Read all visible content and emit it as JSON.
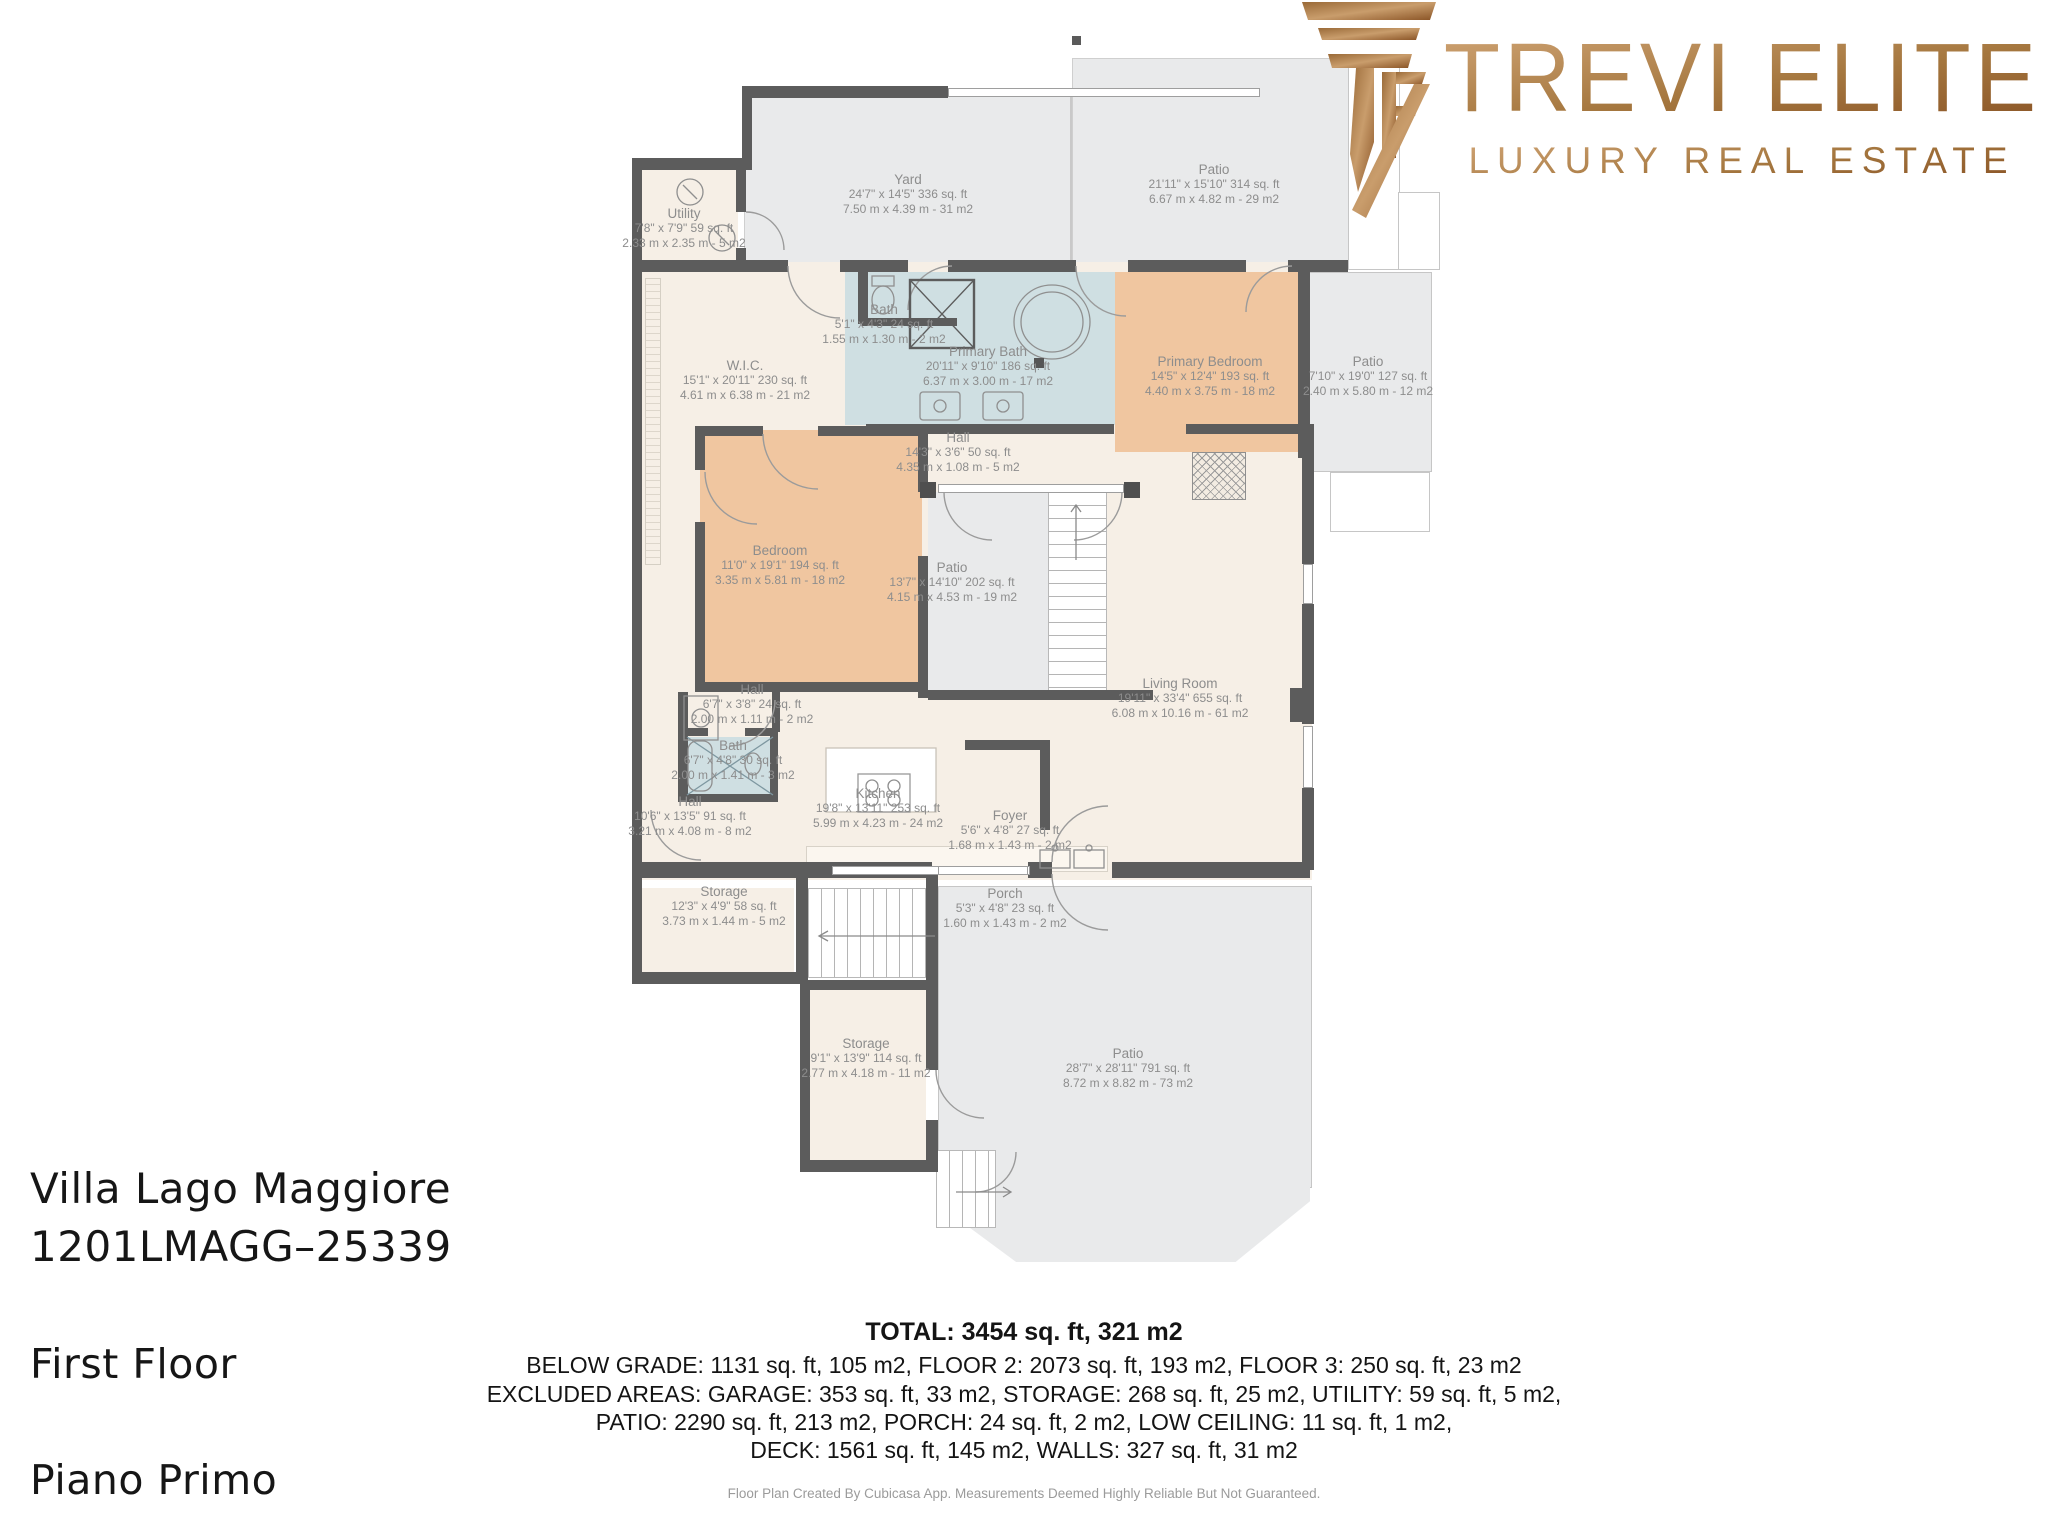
{
  "brand": {
    "monogram": "TE",
    "name": "TREVI ELITE",
    "tagline": "LUXURY REAL ESTATE",
    "gold_dark": "#8a5426",
    "gold_light": "#c99d6c"
  },
  "property": {
    "name": "Villa Lago Maggiore",
    "listing_code": "1201LMAGG–25339",
    "floor_label_en": "First Floor",
    "floor_label_it": "Piano Primo"
  },
  "summary": {
    "total": "TOTAL: 3454 sq. ft, 321 m2",
    "line1": "BELOW GRADE: 1131 sq. ft, 105 m2, FLOOR 2: 2073 sq. ft, 193 m2, FLOOR 3: 250 sq. ft, 23 m2",
    "line2": "EXCLUDED AREAS: GARAGE: 353 sq. ft, 33 m2, STORAGE: 268 sq. ft, 25 m2, UTILITY: 59 sq. ft, 5 m2,",
    "line3": "PATIO: 2290 sq. ft, 213 m2, PORCH: 24 sq. ft, 2 m2, LOW CEILING: 11 sq. ft, 1 m2,",
    "line4": "DECK: 1561 sq. ft, 145 m2, WALLS: 327 sq. ft, 31 m2",
    "disclaimer": "Floor Plan Created By Cubicasa App. Measurements Deemed Highly Reliable But Not Guaranteed."
  },
  "rooms": [
    {
      "name": "Utility",
      "dim_ft": "7'8\" x 7'9\" 59 sq. ft",
      "dim_m": "2.33 m x 2.35 m - 5 m2"
    },
    {
      "name": "Yard",
      "dim_ft": "24'7\" x 14'5\" 336 sq. ft",
      "dim_m": "7.50 m x 4.39 m - 31 m2"
    },
    {
      "name": "Patio",
      "dim_ft": "21'11\" x 15'10\" 314 sq. ft",
      "dim_m": "6.67 m x 4.82 m - 29 m2"
    },
    {
      "name": "W.I.C.",
      "dim_ft": "15'1\" x 20'11\" 230 sq. ft",
      "dim_m": "4.61 m x 6.38 m - 21 m2"
    },
    {
      "name": "Bath",
      "dim_ft": "5'1\" x 4'3\" 24 sq. ft",
      "dim_m": "1.55 m x 1.30 m - 2 m2"
    },
    {
      "name": "Primary Bath",
      "dim_ft": "20'11\" x 9'10\" 186 sq. ft",
      "dim_m": "6.37 m x 3.00 m - 17 m2"
    },
    {
      "name": "Primary Bedroom",
      "dim_ft": "14'5\" x 12'4\" 193 sq. ft",
      "dim_m": "4.40 m x 3.75 m - 18 m2"
    },
    {
      "name": "Patio",
      "dim_ft": "7'10\" x 19'0\" 127 sq. ft",
      "dim_m": "2.40 m x 5.80 m - 12 m2"
    },
    {
      "name": "Hall",
      "dim_ft": "14'3\" x 3'6\" 50 sq. ft",
      "dim_m": "4.35 m x 1.08 m - 5 m2"
    },
    {
      "name": "Bedroom",
      "dim_ft": "11'0\" x 19'1\" 194 sq. ft",
      "dim_m": "3.35 m x 5.81 m - 18 m2"
    },
    {
      "name": "Patio",
      "dim_ft": "13'7\" x 14'10\" 202 sq. ft",
      "dim_m": "4.15 m x 4.53 m - 19 m2"
    },
    {
      "name": "Living Room",
      "dim_ft": "19'11\" x 33'4\" 655 sq. ft",
      "dim_m": "6.08 m x 10.16 m - 61 m2"
    },
    {
      "name": "Hall",
      "dim_ft": "6'7\" x 3'8\" 24 sq. ft",
      "dim_m": "2.00 m x 1.11 m - 2 m2"
    },
    {
      "name": "Bath",
      "dim_ft": "6'7\" x 4'8\" 30 sq. ft",
      "dim_m": "2.00 m x 1.41 m - 3 m2"
    },
    {
      "name": "Hall",
      "dim_ft": "10'6\" x 13'5\" 91 sq. ft",
      "dim_m": "3.21 m x 4.08 m - 8 m2"
    },
    {
      "name": "Kitchen",
      "dim_ft": "19'8\" x 13'11\" 253 sq. ft",
      "dim_m": "5.99 m x 4.23 m - 24 m2"
    },
    {
      "name": "Foyer",
      "dim_ft": "5'6\" x 4'8\" 27 sq. ft",
      "dim_m": "1.68 m x 1.43 m - 2 m2"
    },
    {
      "name": "Storage",
      "dim_ft": "12'3\" x 4'9\" 58 sq. ft",
      "dim_m": "3.73 m x 1.44 m - 5 m2"
    },
    {
      "name": "Porch",
      "dim_ft": "5'3\" x 4'8\" 23 sq. ft",
      "dim_m": "1.60 m x 1.43 m - 2 m2"
    },
    {
      "name": "Storage",
      "dim_ft": "9'1\" x 13'9\" 114 sq. ft",
      "dim_m": "2.77 m x 4.18 m - 11 m2"
    },
    {
      "name": "Patio",
      "dim_ft": "28'7\" x 28'11\" 791 sq. ft",
      "dim_m": "8.72 m x 8.82 m - 73 m2"
    }
  ],
  "palette": {
    "wall": "#5c5c5c",
    "interior_cream": "#f6efe6",
    "bedroom_peach": "#f0c6a0",
    "bath_blue": "#cfdfe2",
    "outdoor_gray": "#e9eaeb",
    "label_gray": "#8d8d8d"
  }
}
